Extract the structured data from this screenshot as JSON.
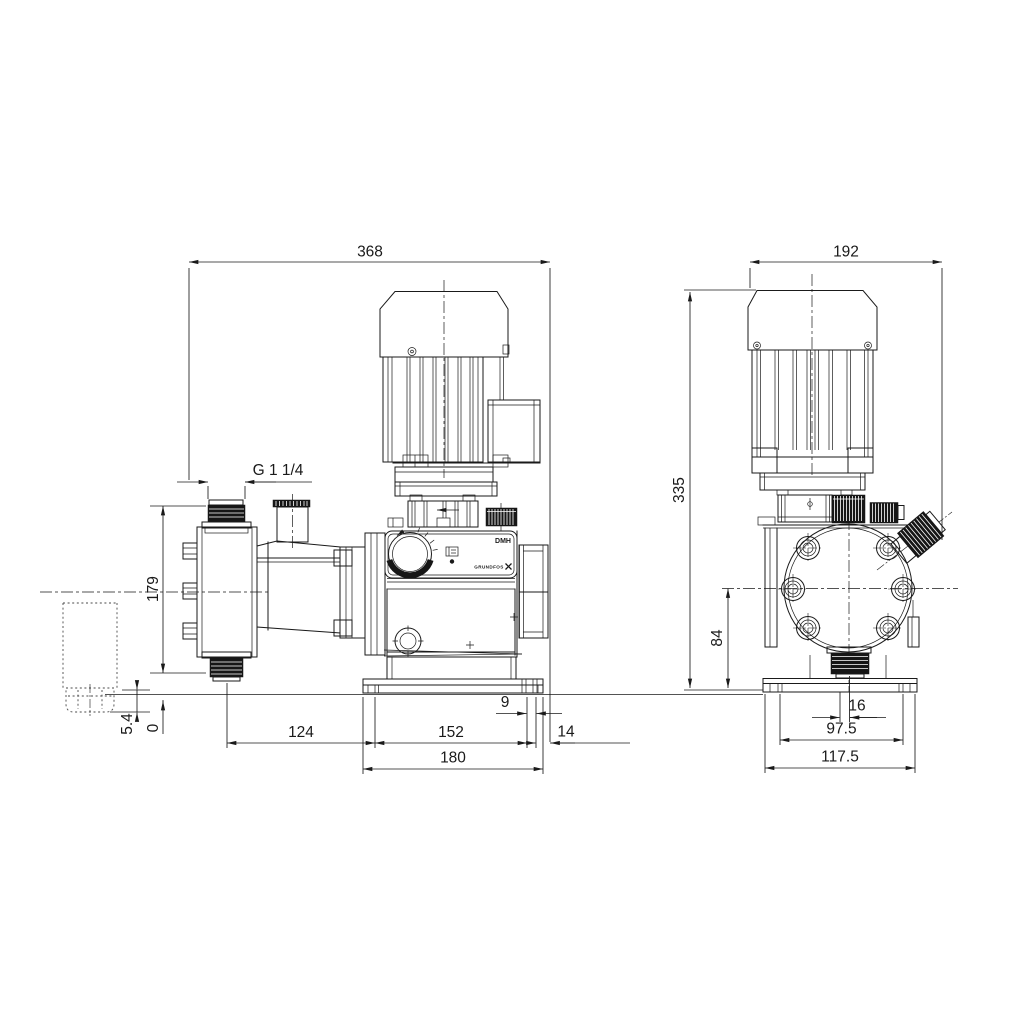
{
  "meta": {
    "background": "#ffffff",
    "line_color": "#1a1a1a"
  },
  "branding": {
    "model": "DMH",
    "logo": "GRUNDFOS"
  },
  "side_view": {
    "dims": {
      "overall_width": "368",
      "connection_thread": "G 1 1/4",
      "connection_span": "179",
      "below_base": "5.4",
      "base_level": "0",
      "valve_to_slot": "124",
      "slot_spacing": "152",
      "slot_width": "9",
      "edge_offset": "14",
      "foot_width": "180"
    }
  },
  "front_view": {
    "dims": {
      "overall_width": "192",
      "overall_height": "335",
      "head_center_height": "84",
      "center_offset": "16",
      "slot_spacing": "97.5",
      "foot_width": "117.5"
    }
  }
}
